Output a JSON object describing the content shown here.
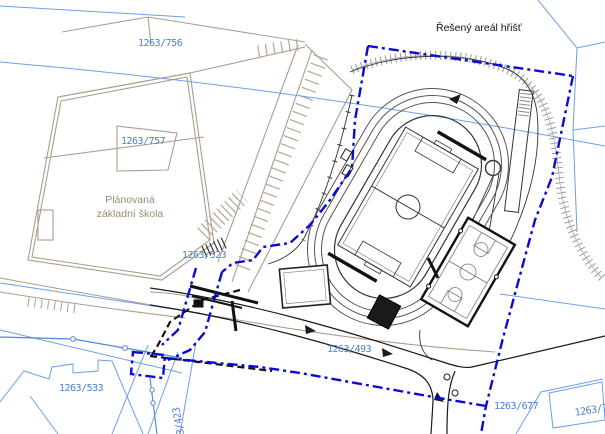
{
  "drawing": {
    "title": "Řešený areál hřišť",
    "school_label_line1": "Plánovaná",
    "school_label_line2": "základní škola",
    "parcels": {
      "p756": "1263/756",
      "p757": "1263/757",
      "p523": "1263/523",
      "p533": "1263/533",
      "p423": "1263/423",
      "p493": "1263/493",
      "p677": "1263/677",
      "p7xx": "1263/7"
    },
    "colors": {
      "site_boundary_blue": "#0a0ad6",
      "cadastre_light_blue": "#6ba0e8",
      "parcel_label_blue": "#4a7fd9",
      "existing_tan": "#ab9d8b",
      "new_linework_black": "#1a1a1a",
      "embankment_gray": "#9a9a9a",
      "background": "#ffffff"
    }
  }
}
